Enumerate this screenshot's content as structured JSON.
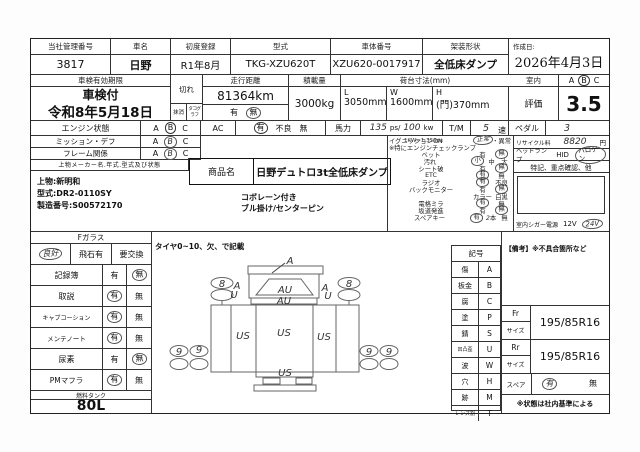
{
  "header_cells": [
    {
      "label": "当社管理番号",
      "value": "3817"
    },
    {
      "label": "車名",
      "value": "日野"
    },
    {
      "label": "初度登録",
      "value": "R1年8月"
    },
    {
      "label": "型式",
      "value": "TKG-XZU620T"
    },
    {
      "label": "車体番号",
      "value": "XZU620-0017917"
    },
    {
      "label": "架装形状",
      "value": "全低床ダンプ"
    },
    {
      "label": "作成日:",
      "value": "2026年4月3日"
    }
  ],
  "shaken": {
    "label": "車検有効期限",
    "status": "車検付",
    "date": "令和8年5月18日",
    "kire": "切れ",
    "masshou": "抹消",
    "tacho": "タコグラフ",
    "tacho_yes": "有",
    "tacho_no": "無"
  },
  "mileage": {
    "label": "走行距離",
    "value": "81364km"
  },
  "load": {
    "label": "積載量",
    "value": "3000kg"
  },
  "bed": {
    "label": "荷台寸法(mm)",
    "l_label": "L",
    "l": "3050mm",
    "w_label": "W",
    "w": "1600mm",
    "h_label": "H",
    "h": "(門)370mm"
  },
  "interior": {
    "label": "室内",
    "a": "A",
    "b": "B",
    "c": "C"
  },
  "rating": {
    "label": "評価",
    "value": "3.5"
  },
  "cond": {
    "engine_label": "エンジン状態",
    "a": "A",
    "b": "B",
    "c": "C",
    "ac_label": "AC",
    "ac_yes": "有",
    "ac_bad": "不良",
    "ac_no": "無",
    "power_label": "馬力",
    "power_ps": "135",
    "power_ps_unit": "ps/",
    "power_kw": "100",
    "power_kw_unit": "kw",
    "tm_label": "T/M",
    "tm_val": "5",
    "tm_unit": "速",
    "pedal_label": "ペダル",
    "pedal_val": "3",
    "kw_note": "1KW=1.359ps",
    "mission_label": "ミッション・デフ",
    "frame_label": "フレーム関係"
  },
  "ubody": {
    "maker_header": "上物メーカー名.年式.型式及び状態",
    "product_label": "商品名",
    "product": "日野デュトロ3t全低床ダンプ",
    "line1": "上物:新明和",
    "line2": "型式:DR2-0110SY",
    "line3": "製造番号:S00572170",
    "note1": "コボレーン付き",
    "note2": "ブル掛け/センターピン"
  },
  "equip": {
    "r1_label": "イグニッションON",
    "r1_ok": "正常",
    "r1_sep": "・",
    "r1_ng": "異常",
    "r2": "※特にエンジンチェックランプ",
    "items": [
      {
        "label": "ベット",
        "o1": "有",
        "o2": "無",
        "circled": "o2"
      },
      {
        "label": "汚れ",
        "o1": "小",
        "o2": "中",
        "o3": "大",
        "circled": "o1"
      },
      {
        "label": "シート破",
        "o1": "有",
        "o2": "無",
        "circled": "o2"
      },
      {
        "label": "ETC",
        "o1": "有",
        "o2": "無",
        "circled": "o1"
      },
      {
        "label": "ラジオ",
        "o1": "有",
        "o2": "不良",
        "circled": "o1"
      },
      {
        "label": "バックモニター",
        "o1": "有",
        "o2": "無",
        "circled": "o2"
      },
      {
        "label": "",
        "o1": "カラー",
        "o2": "白黒",
        "circled": ""
      },
      {
        "label": "電格ミラ",
        "o1": "有",
        "o2": "無",
        "circled": "o1"
      },
      {
        "label": "坂道発進",
        "o1": "有",
        "o2": "無",
        "circled": "o2"
      },
      {
        "label": "スペアキー",
        "o1": "有",
        "num": "2",
        "unit": "本",
        "o3": "無",
        "circled": "o1"
      }
    ],
    "recycle_label": "リサイクル料",
    "recycle": "8820",
    "recycle_unit": "円",
    "headlamp_label": "ヘッドランプ",
    "hid": "HID",
    "halogen": "ハロゲン",
    "tokki": "特記、重点確認、他",
    "cigar_label": "室内シガー電源",
    "v12": "12V",
    "v24": "24V"
  },
  "fglass": {
    "header": "Fガラス",
    "good": "良好",
    "stone": "飛石有",
    "replace": "要交換"
  },
  "checks": [
    {
      "label": "記録簿",
      "yes": "有",
      "no": "無",
      "selected": "no"
    },
    {
      "label": "取説",
      "yes": "有",
      "no": "無",
      "selected": "yes"
    },
    {
      "label": "キャブコーション",
      "yes": "有",
      "no": "無",
      "selected": "yes"
    },
    {
      "label": "メンテノート",
      "yes": "有",
      "no": "無",
      "selected": "yes"
    },
    {
      "label": "尿素",
      "yes": "有",
      "no": "無",
      "selected": "no"
    },
    {
      "label": "PMマフラ",
      "yes": "有",
      "no": "無",
      "selected": "yes"
    }
  ],
  "fuel": {
    "label": "燃料タンク",
    "value": "80L"
  },
  "diagram": {
    "note": "タイヤ0~10、欠、で記載",
    "roof": "A",
    "windshield": "AU",
    "cab": "AU",
    "lf_a": "A",
    "lf_u": "U",
    "rf_a": "A",
    "rf_u": "U",
    "fw_l": "8",
    "fw_r": "8",
    "bed_l": "US",
    "bed_c": "US",
    "bed_r": "US",
    "gate": "US",
    "rw_l1": "9",
    "rw_l2": "9",
    "rw_r1": "9",
    "rw_r2": "9"
  },
  "legend": {
    "title": "記号",
    "rows": [
      {
        "name": "傷",
        "code": "A"
      },
      {
        "name": "板金",
        "code": "B"
      },
      {
        "name": "腐",
        "code": "C"
      },
      {
        "name": "塗",
        "code": "P"
      },
      {
        "name": "錆",
        "code": "S"
      },
      {
        "name": "凹凸歪",
        "code": "U"
      },
      {
        "name": "波",
        "code": "W"
      },
      {
        "name": "穴",
        "code": "H"
      },
      {
        "name": "跡",
        "code": "M"
      },
      {
        "name": "レンズ割",
        "code": "T"
      }
    ]
  },
  "tires": {
    "remarks": "【備考】※不具合箇所など",
    "fr": "Fr",
    "rr": "Rr",
    "size": "サイズ",
    "fr_size": "195/85R16",
    "rr_size": "195/85R16",
    "spare_label": "スペア",
    "yes": "有",
    "no": "無",
    "footnote": "※状態は社内基準による"
  }
}
